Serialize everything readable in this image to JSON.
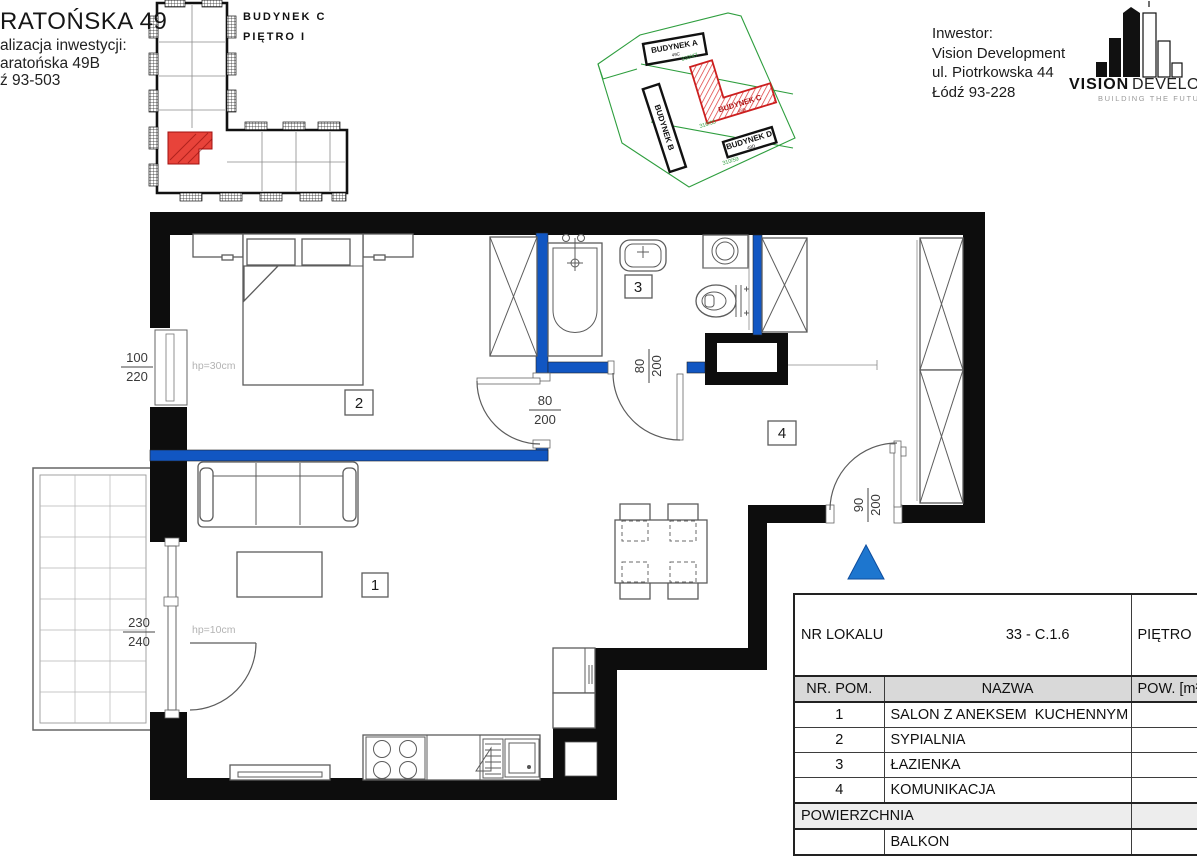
{
  "colors": {
    "wall_blue": "#1156c2",
    "arrow_blue": "#1d76cf",
    "unit_red": "#e8433a",
    "site_green": "#2e9e3e"
  },
  "page_title": {
    "visible_text": "RATOŃSKA 49"
  },
  "location": {
    "line1": "alizacja inwestycji:",
    "line2": "aratońska 49B",
    "line3": "ź 93-503"
  },
  "overview": {
    "building": "BUDYNEK C",
    "floor": "PIĘTRO I"
  },
  "site": {
    "building_a": "BUDYNEK A",
    "building_a_sub": "49C",
    "building_b": "BUDYNEK B",
    "building_c": "BUDYNEK C",
    "building_c_sub": "49B",
    "building_d": "BUDYNEK D",
    "building_d_sub": "49D",
    "parcel_1": "310/47",
    "parcel_2": "310/33",
    "parcel_3": "310/59"
  },
  "investor": {
    "label": "Inwestor:",
    "name": "Vision Development",
    "street": "ul. Piotrkowska 44",
    "city": "Łódź 93-228"
  },
  "logo": {
    "word1": "VISION",
    "word2": "DEVELOPMENT",
    "tagline": "BUILDING THE FUTURE"
  },
  "plan": {
    "rooms": {
      "living": "1",
      "bedroom": "2",
      "bath": "3",
      "hall": "4"
    },
    "dims": {
      "window_num": "100",
      "window_den": "220",
      "balcony_num": "230",
      "balcony_den": "240",
      "bed_door_num": "80",
      "bed_door_den": "200",
      "bath_door_num": "80",
      "bath_door_den": "200",
      "entry_num": "90",
      "entry_den": "200"
    },
    "hp_bedroom": "hp=30cm",
    "hp_living": "hp=10cm"
  },
  "table": {
    "lokal_label": "NR LOKALU",
    "lokal_value": "33 - C.1.6",
    "floor_label": "PIĘTRO",
    "head": {
      "no": "NR. POM.",
      "name": "NAZWA",
      "area": "POW. [m²]"
    },
    "rows": [
      {
        "no": "1",
        "name": "SALON Z ANEKSEM  KUCHENNYM",
        "area": "25"
      },
      {
        "no": "2",
        "name": "SYPIALNIA",
        "area": "13"
      },
      {
        "no": "3",
        "name": "ŁAZIENKA",
        "area": "4"
      },
      {
        "no": "4",
        "name": "KOMUNIKACJA",
        "area": "14"
      }
    ],
    "total_label": "POWIERZCHNIA",
    "total_value": "58",
    "balkon_label": "BALKON",
    "balkon_value": "5"
  }
}
